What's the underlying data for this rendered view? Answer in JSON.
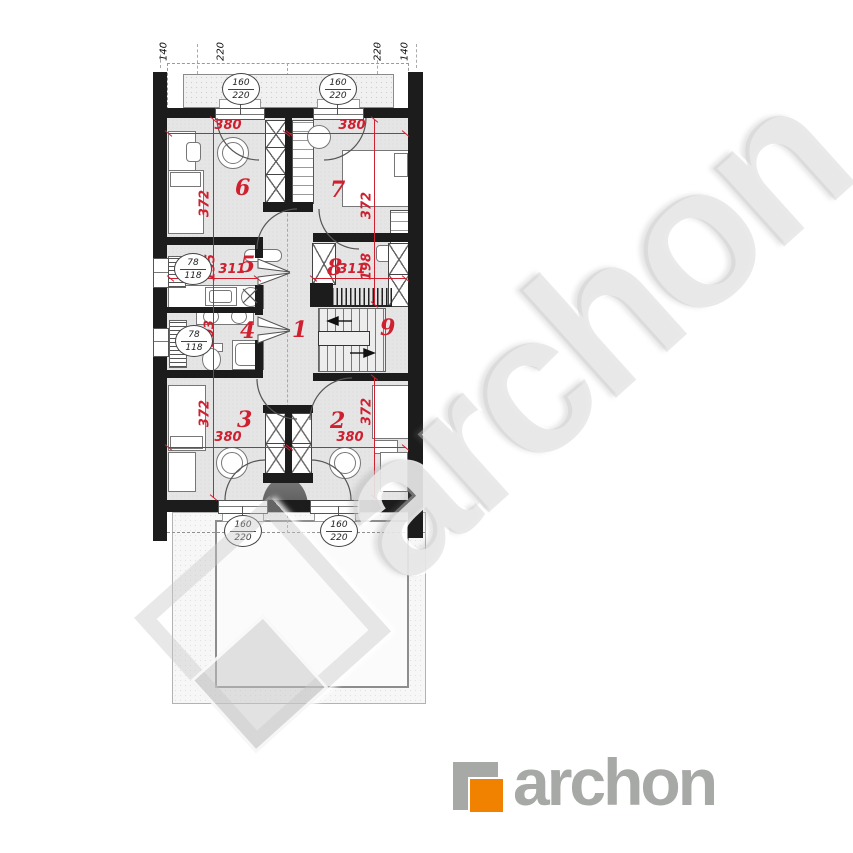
{
  "colors": {
    "wall_black": "#1c1c1c",
    "dimension_red": "#cf2030",
    "logo_orange": "#f08200",
    "logo_gray": "#a7a9a6",
    "floor_gray": "#e5e5e5"
  },
  "top_ruler": {
    "labels": [
      "140",
      "220",
      "220",
      "140"
    ]
  },
  "window_markers": [
    {
      "w": "160",
      "h": "220"
    },
    {
      "w": "160",
      "h": "220"
    },
    {
      "w": "160",
      "h": "220"
    },
    {
      "w": "160",
      "h": "220"
    }
  ],
  "small_window_markers": [
    {
      "w": "78",
      "h": "118"
    },
    {
      "w": "78",
      "h": "118"
    }
  ],
  "rooms": [
    {
      "number": "1"
    },
    {
      "number": "2"
    },
    {
      "number": "3"
    },
    {
      "number": "4"
    },
    {
      "number": "5"
    },
    {
      "number": "6"
    },
    {
      "number": "7"
    },
    {
      "number": "8"
    },
    {
      "number": "9"
    }
  ],
  "dimensions": {
    "room6_width": "380",
    "room7_width": "380",
    "room6_depth": "372",
    "room7_depth": "372",
    "room5_width": "311",
    "room5_depth": "195",
    "room8_width": "311",
    "room8_depth": "198",
    "room4_depth": "203",
    "room3_width": "380",
    "room2_width": "380",
    "room3_depth": "372",
    "room2_depth": "372"
  },
  "watermark": {
    "text": "archon"
  },
  "logo": {
    "text": "archon"
  }
}
